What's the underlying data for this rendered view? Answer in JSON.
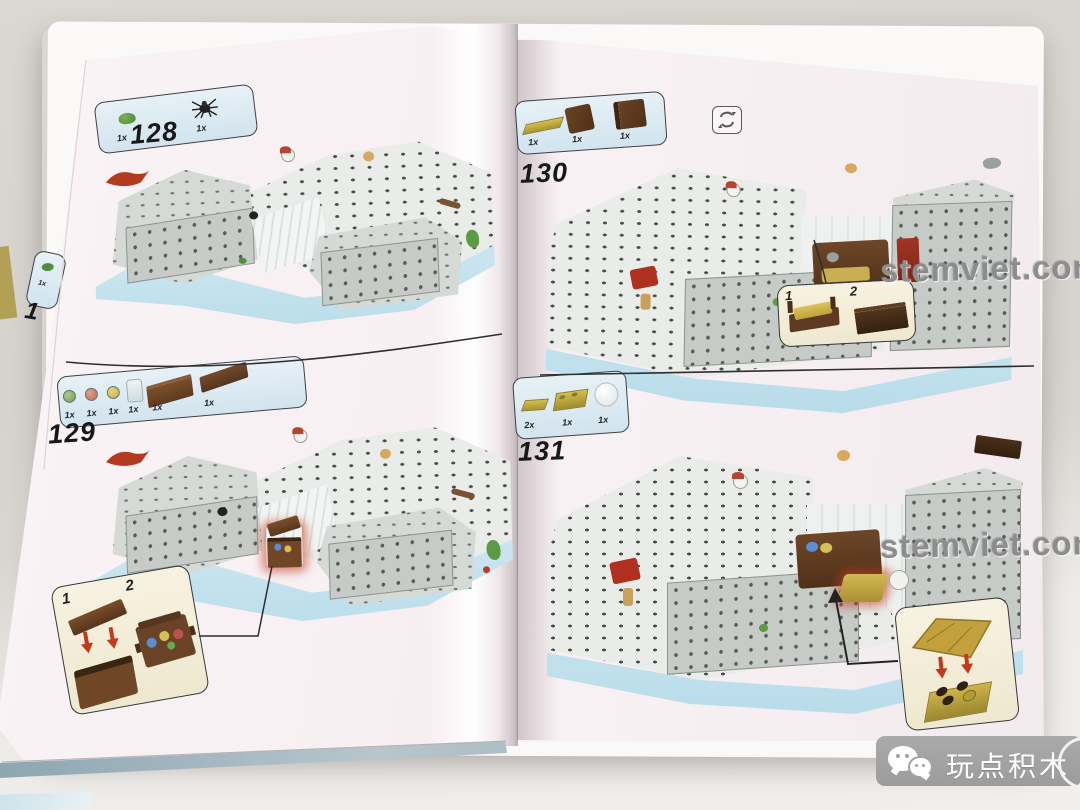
{
  "watermarks": {
    "upper": "stemviet.com",
    "lower": "stemviet.com"
  },
  "badge": {
    "label": "玩点积木"
  },
  "left_page": {
    "prev_step": {
      "number": "1",
      "parts": [
        {
          "icon": "green-piece",
          "count": "1x"
        }
      ]
    },
    "step_128": {
      "number": "128",
      "parts": [
        {
          "icon": "frog",
          "count": "1x"
        },
        {
          "icon": "spider",
          "count": "1x"
        }
      ]
    },
    "step_129": {
      "number": "129",
      "parts": [
        {
          "icon": "green-gem",
          "count": "1x"
        },
        {
          "icon": "red-gem",
          "count": "1x"
        },
        {
          "icon": "yellow-gem",
          "count": "1x"
        },
        {
          "icon": "clear-bottle",
          "count": "1x"
        },
        {
          "icon": "brown-chest-base",
          "count": "1x"
        },
        {
          "icon": "brown-chest-lid",
          "count": "1x"
        }
      ],
      "callout": {
        "step_1": "1",
        "step_2": "2"
      }
    }
  },
  "right_page": {
    "step_130": {
      "number": "130",
      "rotate_icon": "rotate-model",
      "parts": [
        {
          "icon": "tan-plate",
          "count": "1x"
        },
        {
          "icon": "brown-panel",
          "count": "1x"
        },
        {
          "icon": "brown-panel",
          "count": "1x"
        }
      ],
      "callout": {
        "step_1": "1",
        "step_2": "2"
      }
    },
    "step_131": {
      "number": "131",
      "parts": [
        {
          "icon": "yellow-plate-small",
          "count": "2x"
        },
        {
          "icon": "yellow-plate-2x2",
          "count": "1x"
        },
        {
          "icon": "white-dome",
          "count": "1x"
        }
      ]
    }
  },
  "colors": {
    "page": "#f6eef1",
    "parts_box": "#dceaf2",
    "callout_box": "#f4efdc",
    "ice_rim": "#bfe0ec",
    "brown": "#6d4528",
    "highlight": "#c0392b",
    "watermark": "#8e8e8e",
    "badge_bar": "#a2a2a2"
  }
}
